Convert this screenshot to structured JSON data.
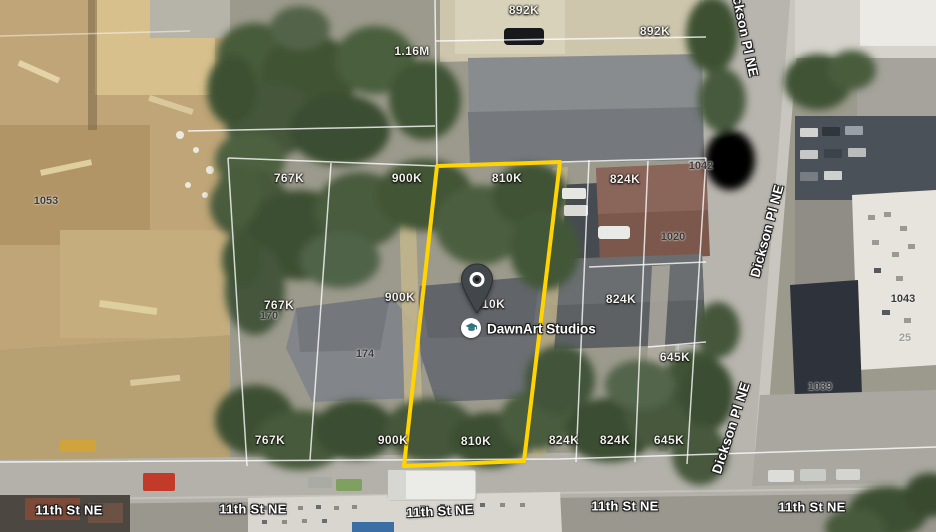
{
  "map_type": "satellite",
  "place": {
    "name": "DawnArt Studios",
    "icon": "graduation-cap-icon"
  },
  "selected_parcel": {
    "value": "810K",
    "outline_color": "#FFD400"
  },
  "labels": {
    "values": [
      "892K",
      "892K",
      "1.16M",
      "767K",
      "900K",
      "810K",
      "824K",
      "767K",
      "900K",
      "810K",
      "824K",
      "645K",
      "767K",
      "900K",
      "810K",
      "824K",
      "824K",
      "645K"
    ],
    "addresses": [
      "1053",
      "170",
      "174",
      "1020",
      "1042",
      "1043",
      "1039",
      "25"
    ],
    "streets": {
      "eleventh": "11th St NE",
      "dickson": "Dickson Pl NE"
    }
  },
  "colors": {
    "parcel_outline": "#FFD400",
    "poi_icon": "#2E7380",
    "pin_body": "#42474C"
  }
}
